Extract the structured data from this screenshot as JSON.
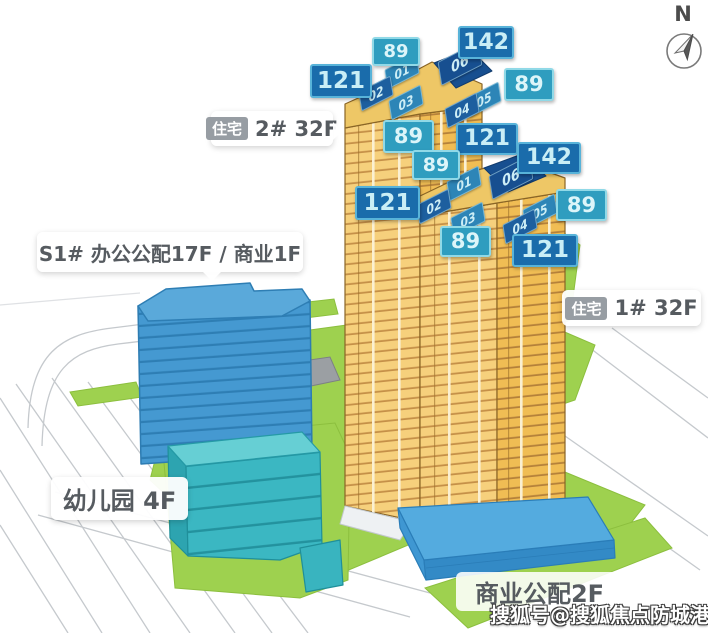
{
  "compass": {
    "label": "N"
  },
  "callouts": {
    "residential2": {
      "chip": "住宅",
      "label": "2# 32F"
    },
    "residential1": {
      "chip": "住宅",
      "label": "1# 32F"
    },
    "office": {
      "label": "S1# 办公公配17F / 商业1F"
    },
    "kindergarten": {
      "label": "幼儿园 4F"
    },
    "retail": {
      "label": "商业公配2F"
    }
  },
  "area_badges": [
    {
      "tower": "2#",
      "unit": "01",
      "value": "89"
    },
    {
      "tower": "2#",
      "unit": "06",
      "value": "142"
    },
    {
      "tower": "2#",
      "unit": "02",
      "value": "121"
    },
    {
      "tower": "2#",
      "unit": "05",
      "value": "89"
    },
    {
      "tower": "2#",
      "unit": "03",
      "value": "89"
    },
    {
      "tower": "2#",
      "unit": "04",
      "value": "121"
    },
    {
      "tower": "1#",
      "unit": "06",
      "value": "142"
    },
    {
      "tower": "1#",
      "unit": "01",
      "value": "89"
    },
    {
      "tower": "1#",
      "unit": "02",
      "value": "121"
    },
    {
      "tower": "1#",
      "unit": "05",
      "value": "89"
    },
    {
      "tower": "1#",
      "unit": "03",
      "value": "89"
    },
    {
      "tower": "1#",
      "unit": "04",
      "value": "121"
    }
  ],
  "unit_tiles": [
    {
      "tower": "2#",
      "label": "01"
    },
    {
      "tower": "2#",
      "label": "02"
    },
    {
      "tower": "2#",
      "label": "03"
    },
    {
      "tower": "2#",
      "label": "06"
    },
    {
      "tower": "2#",
      "label": "05"
    },
    {
      "tower": "2#",
      "label": "04"
    },
    {
      "tower": "1#",
      "label": "01"
    },
    {
      "tower": "1#",
      "label": "02"
    },
    {
      "tower": "1#",
      "label": "03"
    },
    {
      "tower": "1#",
      "label": "06"
    },
    {
      "tower": "1#",
      "label": "05"
    },
    {
      "tower": "1#",
      "label": "04"
    }
  ],
  "watermark": {
    "text": "搜狐号@搜狐焦点防城港站"
  },
  "colors": {
    "badge_dark": "#1a6cab",
    "badge_teal": "#2f9dbf",
    "tile_navy": "#174f90",
    "tower_yellow": "#f2c35e",
    "office_blue": "#4599d1",
    "kindergarten_teal": "#3bb7c2",
    "podium_blue": "#54abdf",
    "greenery": "#9ed14f"
  }
}
